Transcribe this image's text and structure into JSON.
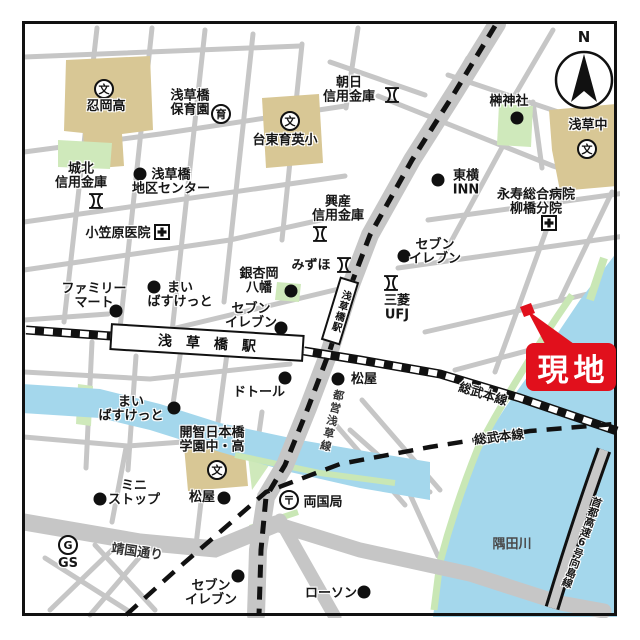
{
  "map": {
    "compass_label": "N",
    "site_label": "現地",
    "stations": {
      "jr": "浅草橋駅",
      "subway": "浅草橋駅"
    },
    "lines": {
      "sobu_main_upper": "総武本線",
      "sobu_main_lower": "総武本線",
      "toei_asakusa": "都営浅草線"
    },
    "roads": {
      "yasukuni_dori": "靖国通り",
      "shuto_expressway": "首都高速6号向島線"
    },
    "water": {
      "sumida_river": "隅田川"
    },
    "icon_glyphs": {
      "school": "文",
      "nursery": "育",
      "post": "〒",
      "gas": "G"
    },
    "pois": {
      "oshioka_high": {
        "label": "忍岡高"
      },
      "asakusabashi_hoikuen": {
        "label": "浅草橋\n保育園"
      },
      "asahi_shinkin": {
        "label": "朝日\n信用金庫"
      },
      "taito_ikuei_elem": {
        "label": "台東育英小"
      },
      "sakaki_shrine": {
        "label": "榊神社"
      },
      "asakusa_jhs": {
        "label": "浅草中"
      },
      "johoku_shinkin": {
        "label": "城北\n信用金庫"
      },
      "chiku_center": {
        "label": "浅草橋\n地区センター"
      },
      "ogasawara_clinic": {
        "label": "小笠原医院"
      },
      "kosan_shinkin": {
        "label": "興産\n信用金庫"
      },
      "toyoko_inn": {
        "label": "東横\nINN"
      },
      "eiju_hospital": {
        "label": "永寿総合病院\n柳橋分院"
      },
      "mizuho": {
        "label": "みずほ"
      },
      "ginnanoka_hachiman": {
        "label": "銀杏岡\n八幡"
      },
      "seven_eleven_north": {
        "label": "セブン\nイレブン"
      },
      "mufg": {
        "label": "三菱\nUFJ"
      },
      "family_mart": {
        "label": "ファミリー\nマート"
      },
      "maibasket_north": {
        "label": "まい\nばすけっと"
      },
      "seven_eleven_west": {
        "label": "セブン\nイレブン"
      },
      "doutor": {
        "label": "ドトール"
      },
      "matsuya_center": {
        "label": "松屋"
      },
      "maibasket_south": {
        "label": "まい\nばすけっと"
      },
      "kaichi_school": {
        "label": "開智日本橋\n学園中・高"
      },
      "ministop": {
        "label": "ミニ\nストップ"
      },
      "matsuya_south": {
        "label": "松屋"
      },
      "ryogoku_post": {
        "label": "両国局"
      },
      "gas_station": {
        "label": "GS"
      },
      "seven_eleven_south": {
        "label": "セブン\nイレブン"
      },
      "lawson": {
        "label": "ローソン"
      }
    },
    "colors": {
      "road": "#c6c6c6",
      "river": "#a4d7ec",
      "park": "#cfe9bb",
      "building": "#d8c795",
      "site_red": "#e1101c"
    }
  }
}
